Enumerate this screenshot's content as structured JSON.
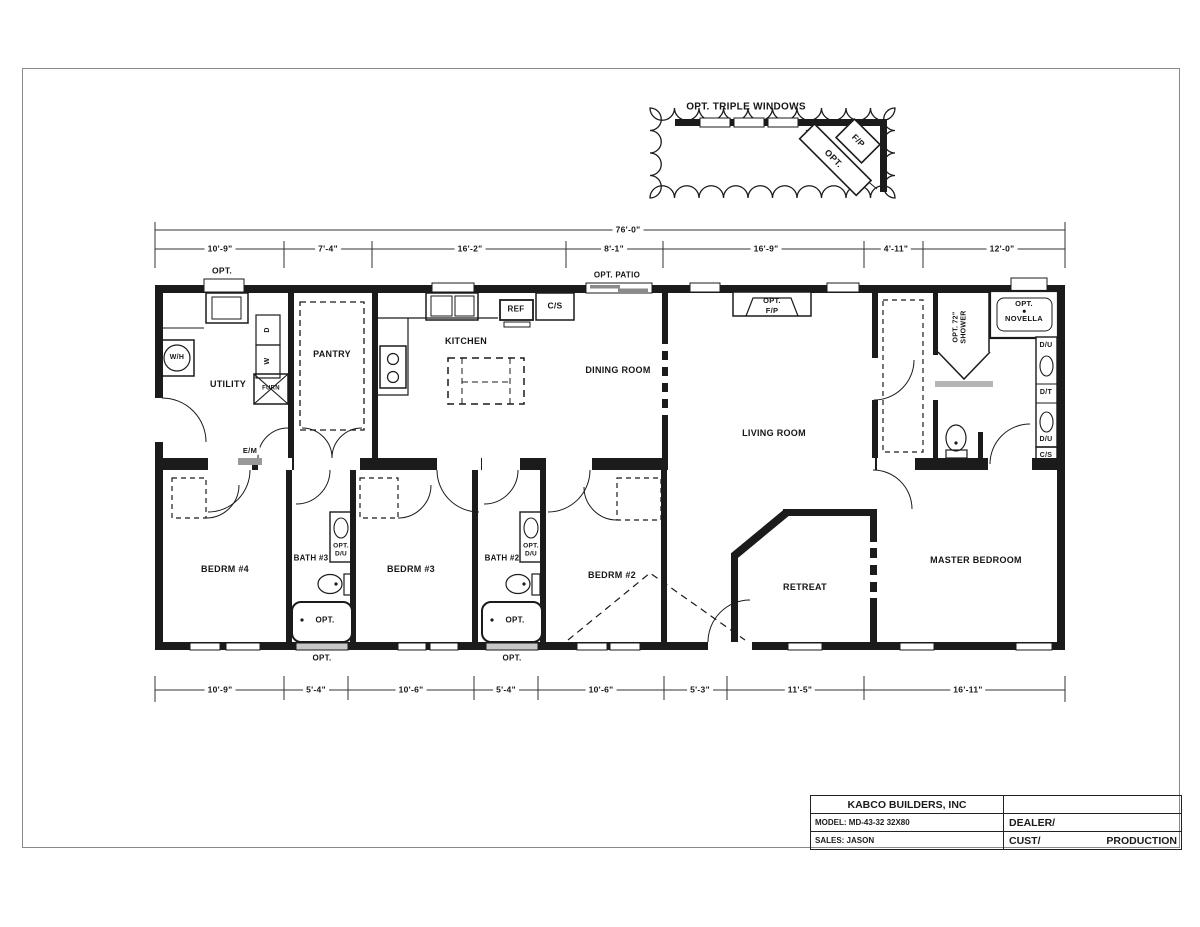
{
  "page": {
    "background": "#ffffff",
    "ink": "#1b1b1b"
  },
  "callout": {
    "title": "OPT. TRIPLE WINDOWS",
    "fp": "F/P",
    "opt": "OPT."
  },
  "dimensions": {
    "overall": "76'-0\"",
    "top": [
      "10'-9\"",
      "7'-4\"",
      "16'-2\"",
      "8'-1\"",
      "16'-9\"",
      "4'-11\"",
      "12'-0\""
    ],
    "bottom": [
      "10'-9\"",
      "5'-4\"",
      "10'-6\"",
      "5'-4\"",
      "10'-6\"",
      "5'-3\"",
      "11'-5\"",
      "16'-11\""
    ]
  },
  "rooms": {
    "utility": "UTILITY",
    "pantry": "PANTRY",
    "kitchen": "KITCHEN",
    "dining_room": "DINING ROOM",
    "living_room": "LIVING ROOM",
    "master_bedroom": "MASTER BEDROOM",
    "retreat": "RETREAT",
    "bedroom_2": "BEDRM #2",
    "bedroom_3": "BEDRM #3",
    "bedroom_4": "BEDRM #4",
    "bath_2": "BATH #2",
    "bath_3": "BATH #3"
  },
  "labels": {
    "opt": "OPT.",
    "opt_patio": "OPT. PATIO",
    "fp": "F/P",
    "water_heater": "W/H",
    "washer": "W",
    "dryer": "D",
    "furnace": "FURN",
    "electric_meter": "E/M",
    "refrigerator": "REF",
    "cs": "C/S",
    "du": "D/U",
    "dt": "D/T",
    "opt_shower_line1": "OPT. 72\"",
    "opt_shower_line2": "SHOWER",
    "novella": "NOVELLA"
  },
  "title_block": {
    "company": "KABCO BUILDERS, INC",
    "model": "MODEL: MD-43-32 32X80",
    "sales": "SALES: JASON",
    "dealer": "DEALER/",
    "customer": "CUST/",
    "status": "PRODUCTION"
  }
}
